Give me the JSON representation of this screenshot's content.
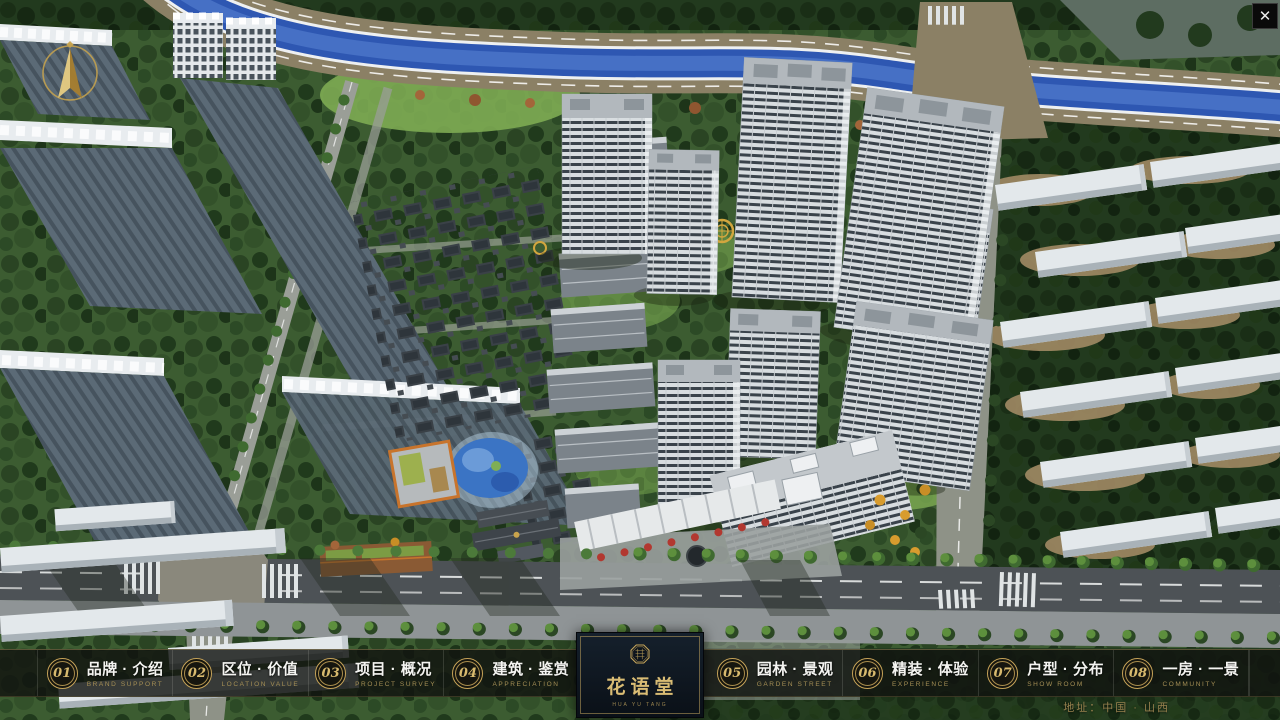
{
  "window": {
    "close": "✕"
  },
  "logo": {
    "title": "花语堂",
    "caption": "HUA YU TANG"
  },
  "menu": {
    "items": [
      {
        "num": "01",
        "zh": "品牌 · 介绍",
        "en": "BRAND SUPPORT"
      },
      {
        "num": "02",
        "zh": "区位 · 价值",
        "en": "LOCATION VALUE"
      },
      {
        "num": "03",
        "zh": "项目 · 概况",
        "en": "PROJECT SURVEY"
      },
      {
        "num": "04",
        "zh": "建筑 · 鉴赏",
        "en": "APPRECIATION"
      },
      {
        "num": "05",
        "zh": "园林 · 景观",
        "en": "GARDEN STREET"
      },
      {
        "num": "06",
        "zh": "精装 · 体验",
        "en": "EXPERIENCE"
      },
      {
        "num": "07",
        "zh": "户型 · 分布",
        "en": "SHOW ROOM"
      },
      {
        "num": "08",
        "zh": "一房 · 一景",
        "en": "COMMUNITY"
      }
    ]
  },
  "footer": {
    "address": "地址：中国 · 山西"
  },
  "colors": {
    "accent_gold": "#c6a358",
    "bar_bg": "rgba(17,19,16,0.82)",
    "logo_bg": "#0d141d",
    "river_blue": "#2e57b2"
  }
}
